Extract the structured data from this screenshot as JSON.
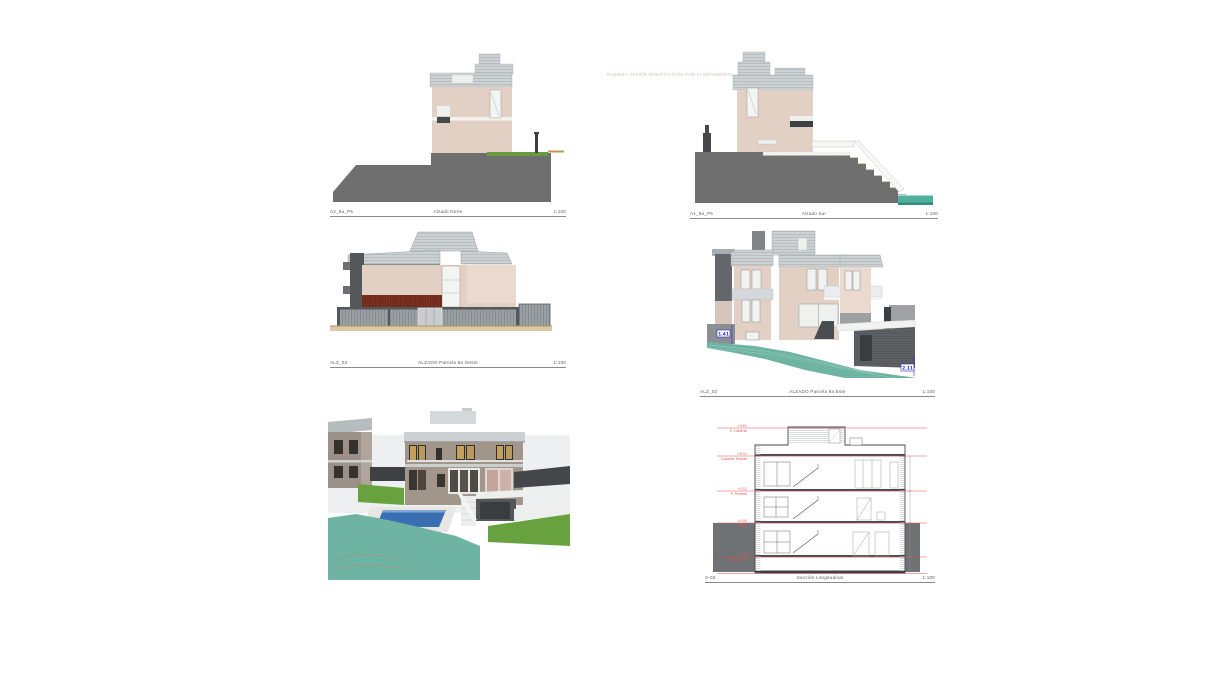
{
  "note": {
    "text": "PUDIERA SUFRIR MODIFICACIÓN POR AYUNTAMIENTO"
  },
  "panels": {
    "norte": {
      "code": "A2_9a_P6",
      "title": "Alzado Norte",
      "scale": "1:100"
    },
    "sur": {
      "code": "A1_9a_P6",
      "title": "Alzado Sur",
      "scale": "1:100"
    },
    "oeste": {
      "code": "ALZ_03",
      "title": "ALZADO Parcela 9a Oeste",
      "scale": "1:100"
    },
    "este": {
      "code": "ALZ_02",
      "title": "ALZADO Parcela 9a Este",
      "scale": "1:100"
    },
    "seccion": {
      "code": "S-02",
      "title": "Sección Longitudinal",
      "scale": "1:100"
    }
  },
  "dims": {
    "este_left": "1.41",
    "este_right": "2.11"
  },
  "section_levels": [
    {
      "value": "+9.61",
      "name": "P. Cubierta"
    },
    {
      "value": "+6.51",
      "name": "Cubierta Terraza"
    },
    {
      "value": "+3.51",
      "name": "P. Primera"
    },
    {
      "value": "+0.00",
      "name": "P. Baja"
    },
    {
      "value": "-2.80",
      "name": "P. Semisótano"
    }
  ],
  "palette": {
    "hill_gray": "#6f6f6f",
    "roof_gray": "#ccd1d4",
    "wall_beige": "#e2d0c4",
    "wall_pink": "#ead9cf",
    "grass_green": "#67993f",
    "terrain_teal": "#6fb3a2",
    "pool_teal": "#4fb09c",
    "pool_blue": "#3a6fb4",
    "maroon_band": "#7c3020",
    "fence_gray": "#9aa0a3",
    "dark_accent": "#45484a",
    "level_red": "#d9534f",
    "dim_blue": "#2a2ac8",
    "ground_tan": "#d9c9a7"
  }
}
